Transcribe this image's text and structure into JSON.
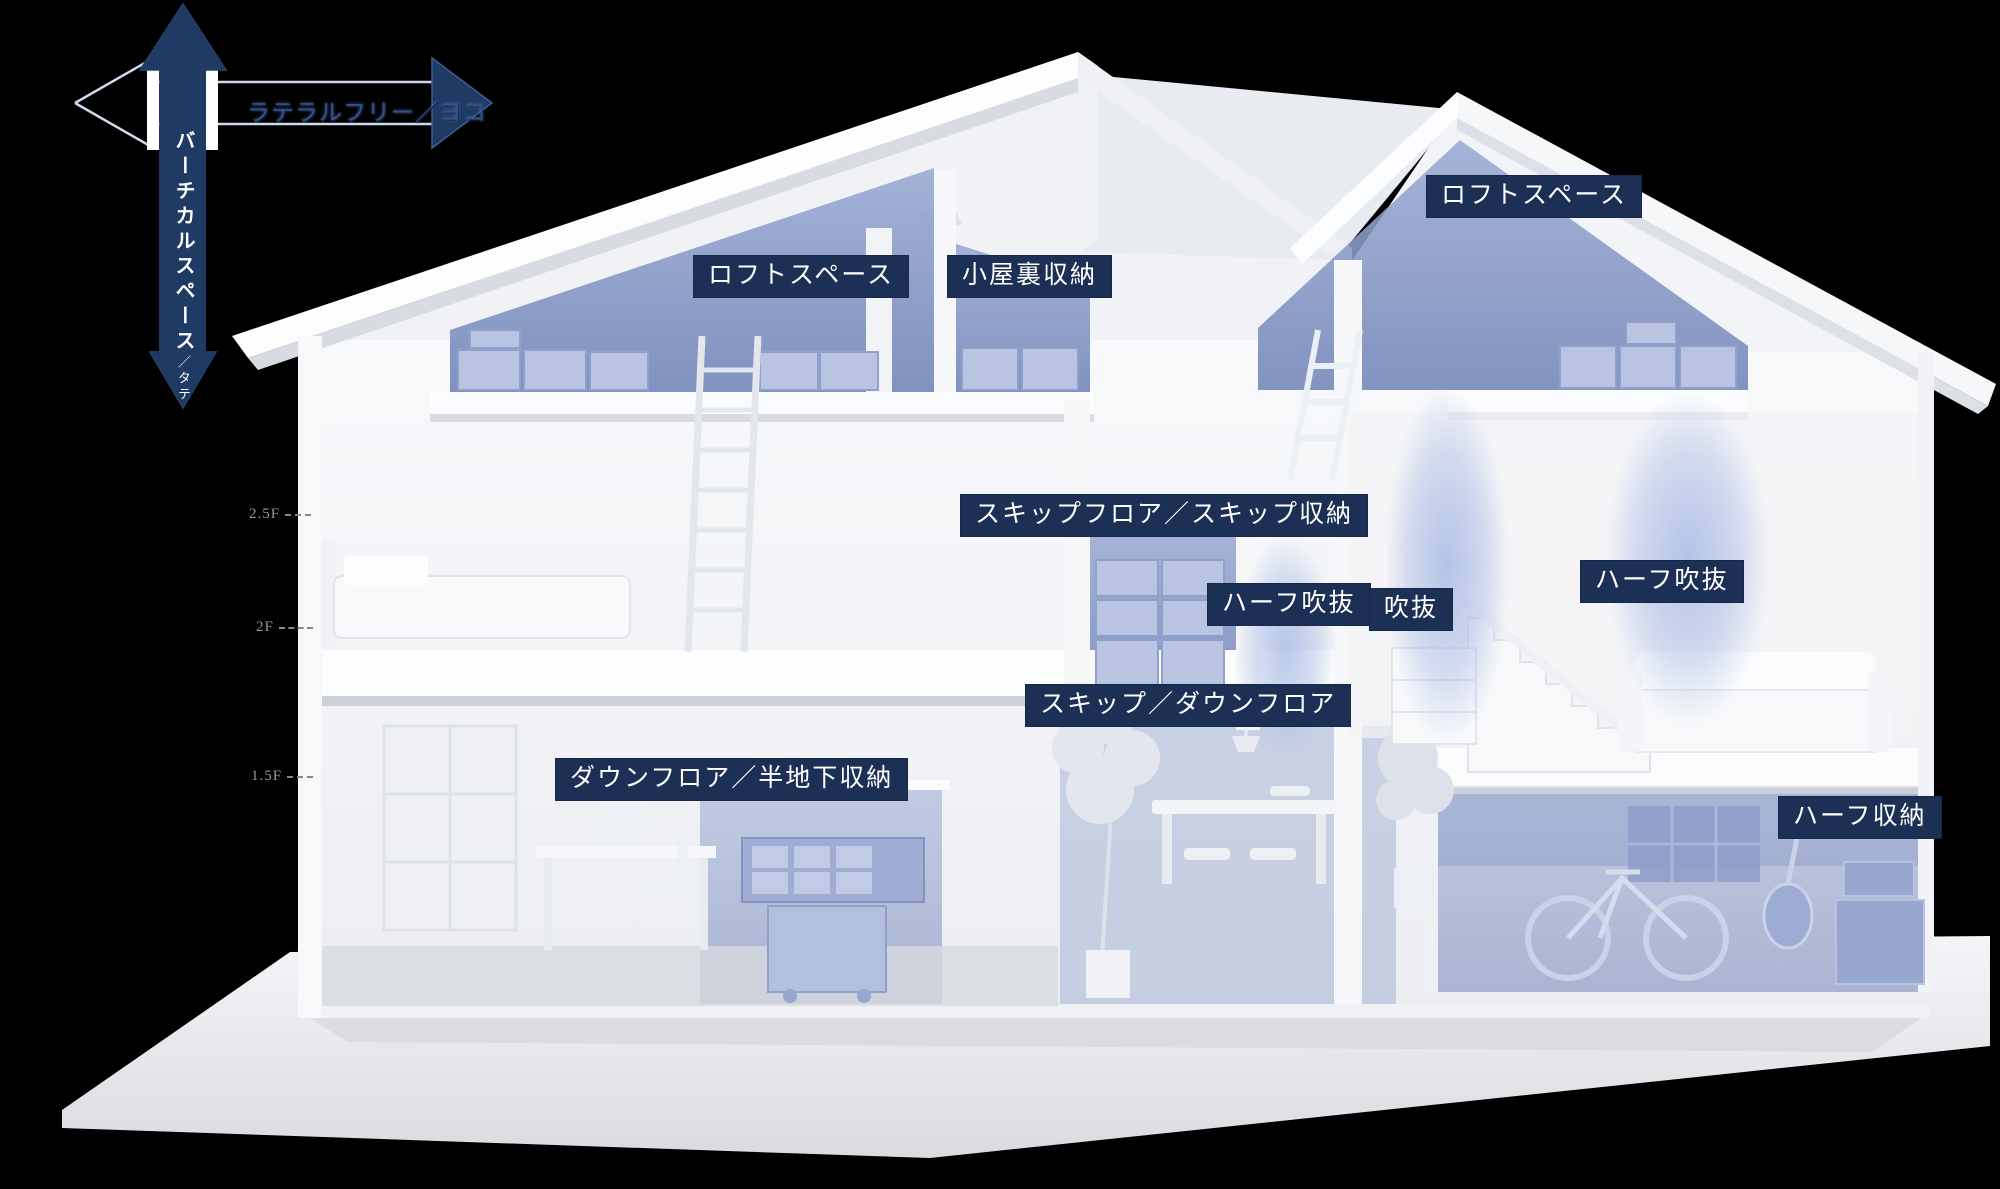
{
  "axis": {
    "vertical_label": "バーチカルスペース",
    "vertical_suffix": "／タテ",
    "horizontal_label": "ラテラルフリー／ヨコ"
  },
  "floor_markers": [
    {
      "label": "2.5F"
    },
    {
      "label": "2F"
    },
    {
      "label": "1.5F"
    }
  ],
  "zone_labels": [
    {
      "id": "loft-left",
      "text": "ロフトスペース"
    },
    {
      "id": "attic-storage",
      "text": "小屋裏収納"
    },
    {
      "id": "loft-right",
      "text": "ロフトスペース"
    },
    {
      "id": "skip-floor",
      "text": "スキップフロア／スキップ収納"
    },
    {
      "id": "half-void-left",
      "text": "ハーフ吹抜"
    },
    {
      "id": "void",
      "text": "吹抜"
    },
    {
      "id": "half-void-right",
      "text": "ハーフ吹抜"
    },
    {
      "id": "skip-down-floor",
      "text": "スキップ／ダウンフロア"
    },
    {
      "id": "down-floor",
      "text": "ダウンフロア／半地下収納"
    },
    {
      "id": "half-storage",
      "text": "ハーフ収納"
    }
  ],
  "colors": {
    "background": "#000000",
    "label_navy": "#1c2f55",
    "arrow_navy": "#1f3a63",
    "zone_blue": "#8a9cc8",
    "glow_blue": "#a9bce6",
    "marker_grey": "#97999d",
    "house_white": "#f5f6f8"
  }
}
